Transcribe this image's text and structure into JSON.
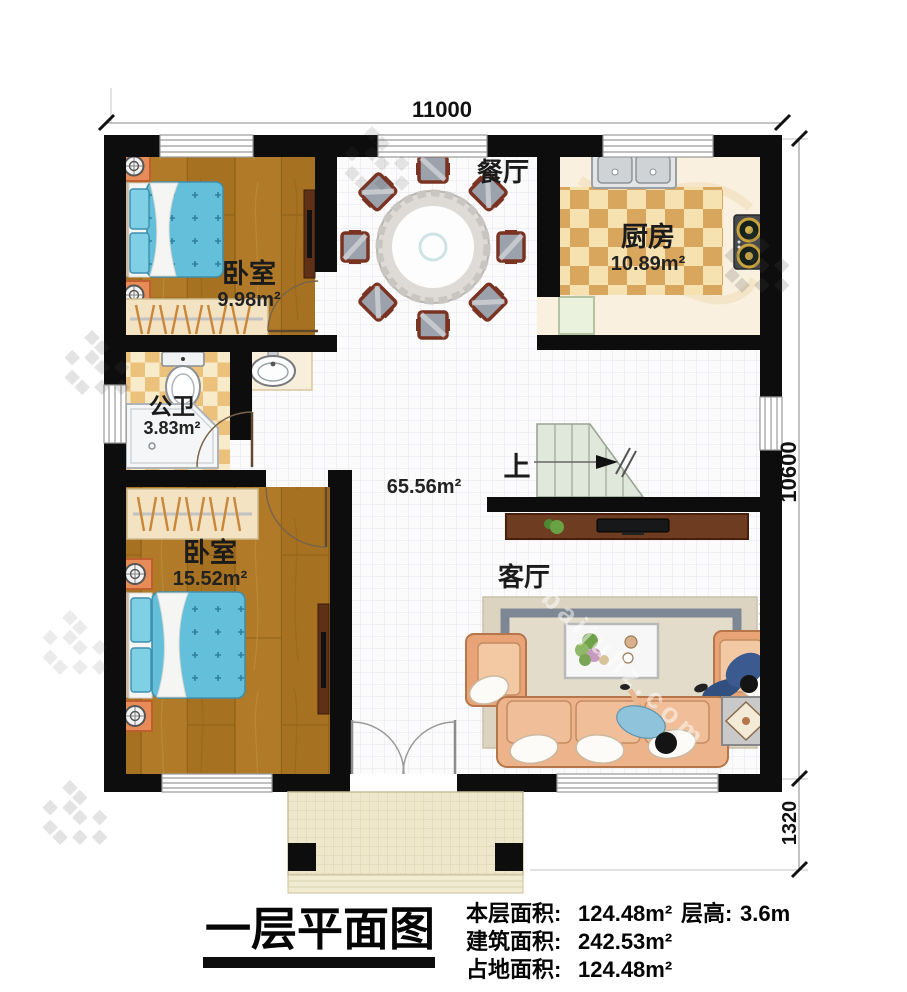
{
  "plan": {
    "title": "一层平面图",
    "dimensions": {
      "top_width": "11000",
      "right_height": "10600",
      "porch_depth": "1320"
    },
    "rooms": {
      "bedroom_top": {
        "name": "卧室",
        "area": "9.98m²"
      },
      "kitchen": {
        "name": "厨房",
        "area": "10.89m²"
      },
      "dining": {
        "name": "餐厅"
      },
      "bathroom": {
        "name": "公卫",
        "area": "3.83m²"
      },
      "bedroom_bottom": {
        "name": "卧室",
        "area": "15.52m²"
      },
      "living": {
        "name": "客厅"
      },
      "hall": {
        "area": "65.56m²"
      },
      "stairs": {
        "label": "上"
      }
    },
    "stats": {
      "floor_area": {
        "label": "本层面积:",
        "value": "124.48m²"
      },
      "building_area": {
        "label": "建筑面积:",
        "value": "242.53m²"
      },
      "land_area": {
        "label": "占地面积:",
        "value": "124.48m²"
      },
      "floor_height": {
        "label": "层高:",
        "value": "3.6m"
      }
    },
    "watermark": "baijuhz.com"
  }
}
